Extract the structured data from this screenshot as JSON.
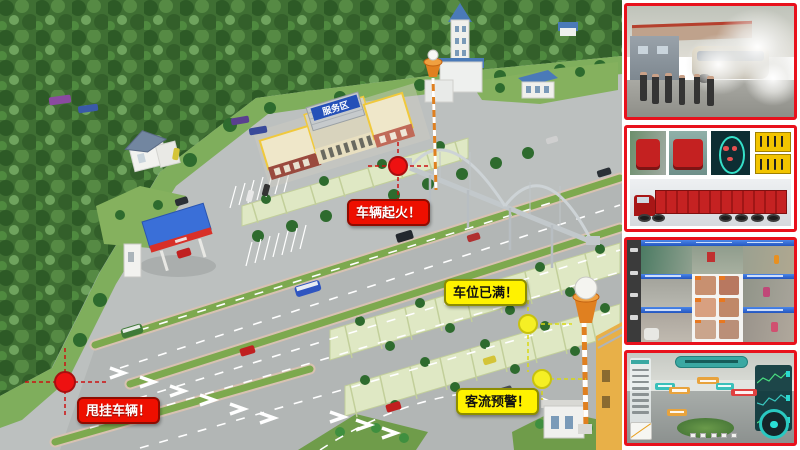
{
  "scene": {
    "building_sign": "服务区",
    "alerts": [
      {
        "id": "vehicle_fire",
        "text": "车辆起火！",
        "style": "red"
      },
      {
        "id": "parking_full",
        "text": "车位已满！",
        "style": "yellow"
      },
      {
        "id": "passenger_flow",
        "text": "客流预警！",
        "style": "yellow"
      },
      {
        "id": "trailer_swap",
        "text": "甩挂车辆！",
        "style": "red"
      }
    ],
    "colors": {
      "alert_red": "#ee0f00",
      "alert_yellow": "#fff200",
      "marker_red": "#ee1111",
      "marker_yellow": "#f5e922",
      "photo_border_red": "#e8111c",
      "road_gray": "#bcc0bf",
      "forest_green": "#3f6f33",
      "median_green": "#7da94e",
      "gas_canopy_blue": "#3a6fd8",
      "gas_band_red": "#d83028",
      "tower_orange": "#e08020",
      "building_trim_yellow": "#f0c93c",
      "sign_blue": "#2450b8"
    }
  },
  "sidebar": {
    "photos": [
      {
        "name": "vehicle-fire-drill-photo"
      },
      {
        "name": "truck-license-recognition-photo"
      },
      {
        "name": "surveillance-face-grid-photo"
      },
      {
        "name": "smart-parking-ar-monitor-photo"
      }
    ]
  }
}
